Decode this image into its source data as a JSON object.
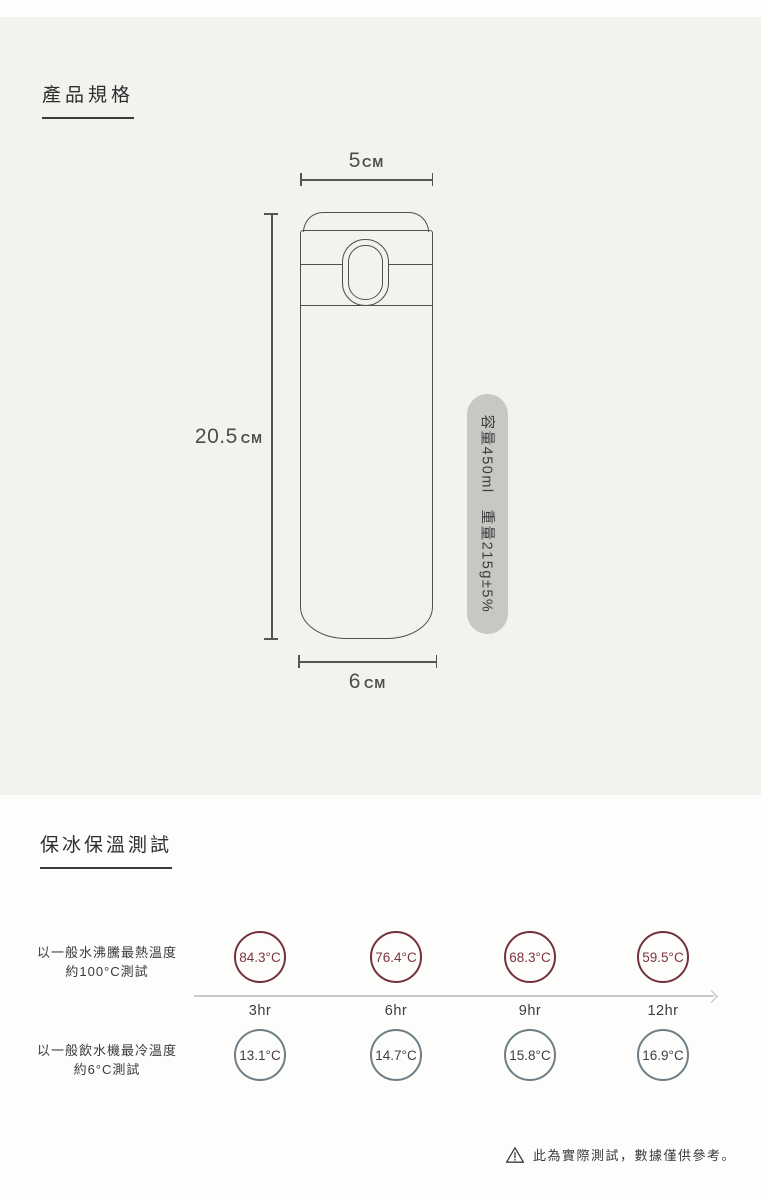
{
  "specs": {
    "title": "產品規格",
    "measurements": {
      "top_width": {
        "value": "5",
        "unit": "CM"
      },
      "height": {
        "value": "20.5",
        "unit": "CM"
      },
      "bottom_width": {
        "value": "6",
        "unit": "CM"
      }
    },
    "badge_text": "容量450ml　重量215g±5%"
  },
  "test": {
    "title": "保冰保溫測試",
    "rows": [
      {
        "name": "hot",
        "label_line1": "以一般水沸騰最熱溫度",
        "label_line2": "約100°C測試",
        "values": [
          "84.3°C",
          "76.4°C",
          "68.3°C",
          "59.5°C"
        ]
      },
      {
        "name": "cold",
        "label_line1": "以一般飲水機最冷溫度",
        "label_line2": "約6°C測試",
        "values": [
          "13.1°C",
          "14.7°C",
          "15.8°C",
          "16.9°C"
        ]
      }
    ],
    "time_labels": [
      "3hr",
      "6hr",
      "9hr",
      "12hr"
    ],
    "note": "此為實際測試，數據僅供參考。"
  },
  "colors": {
    "hot_circle": "#733042",
    "cold_circle": "#6f7e85",
    "badge_background": "#c9c7c4",
    "specs_background": "#f3f2ef"
  }
}
